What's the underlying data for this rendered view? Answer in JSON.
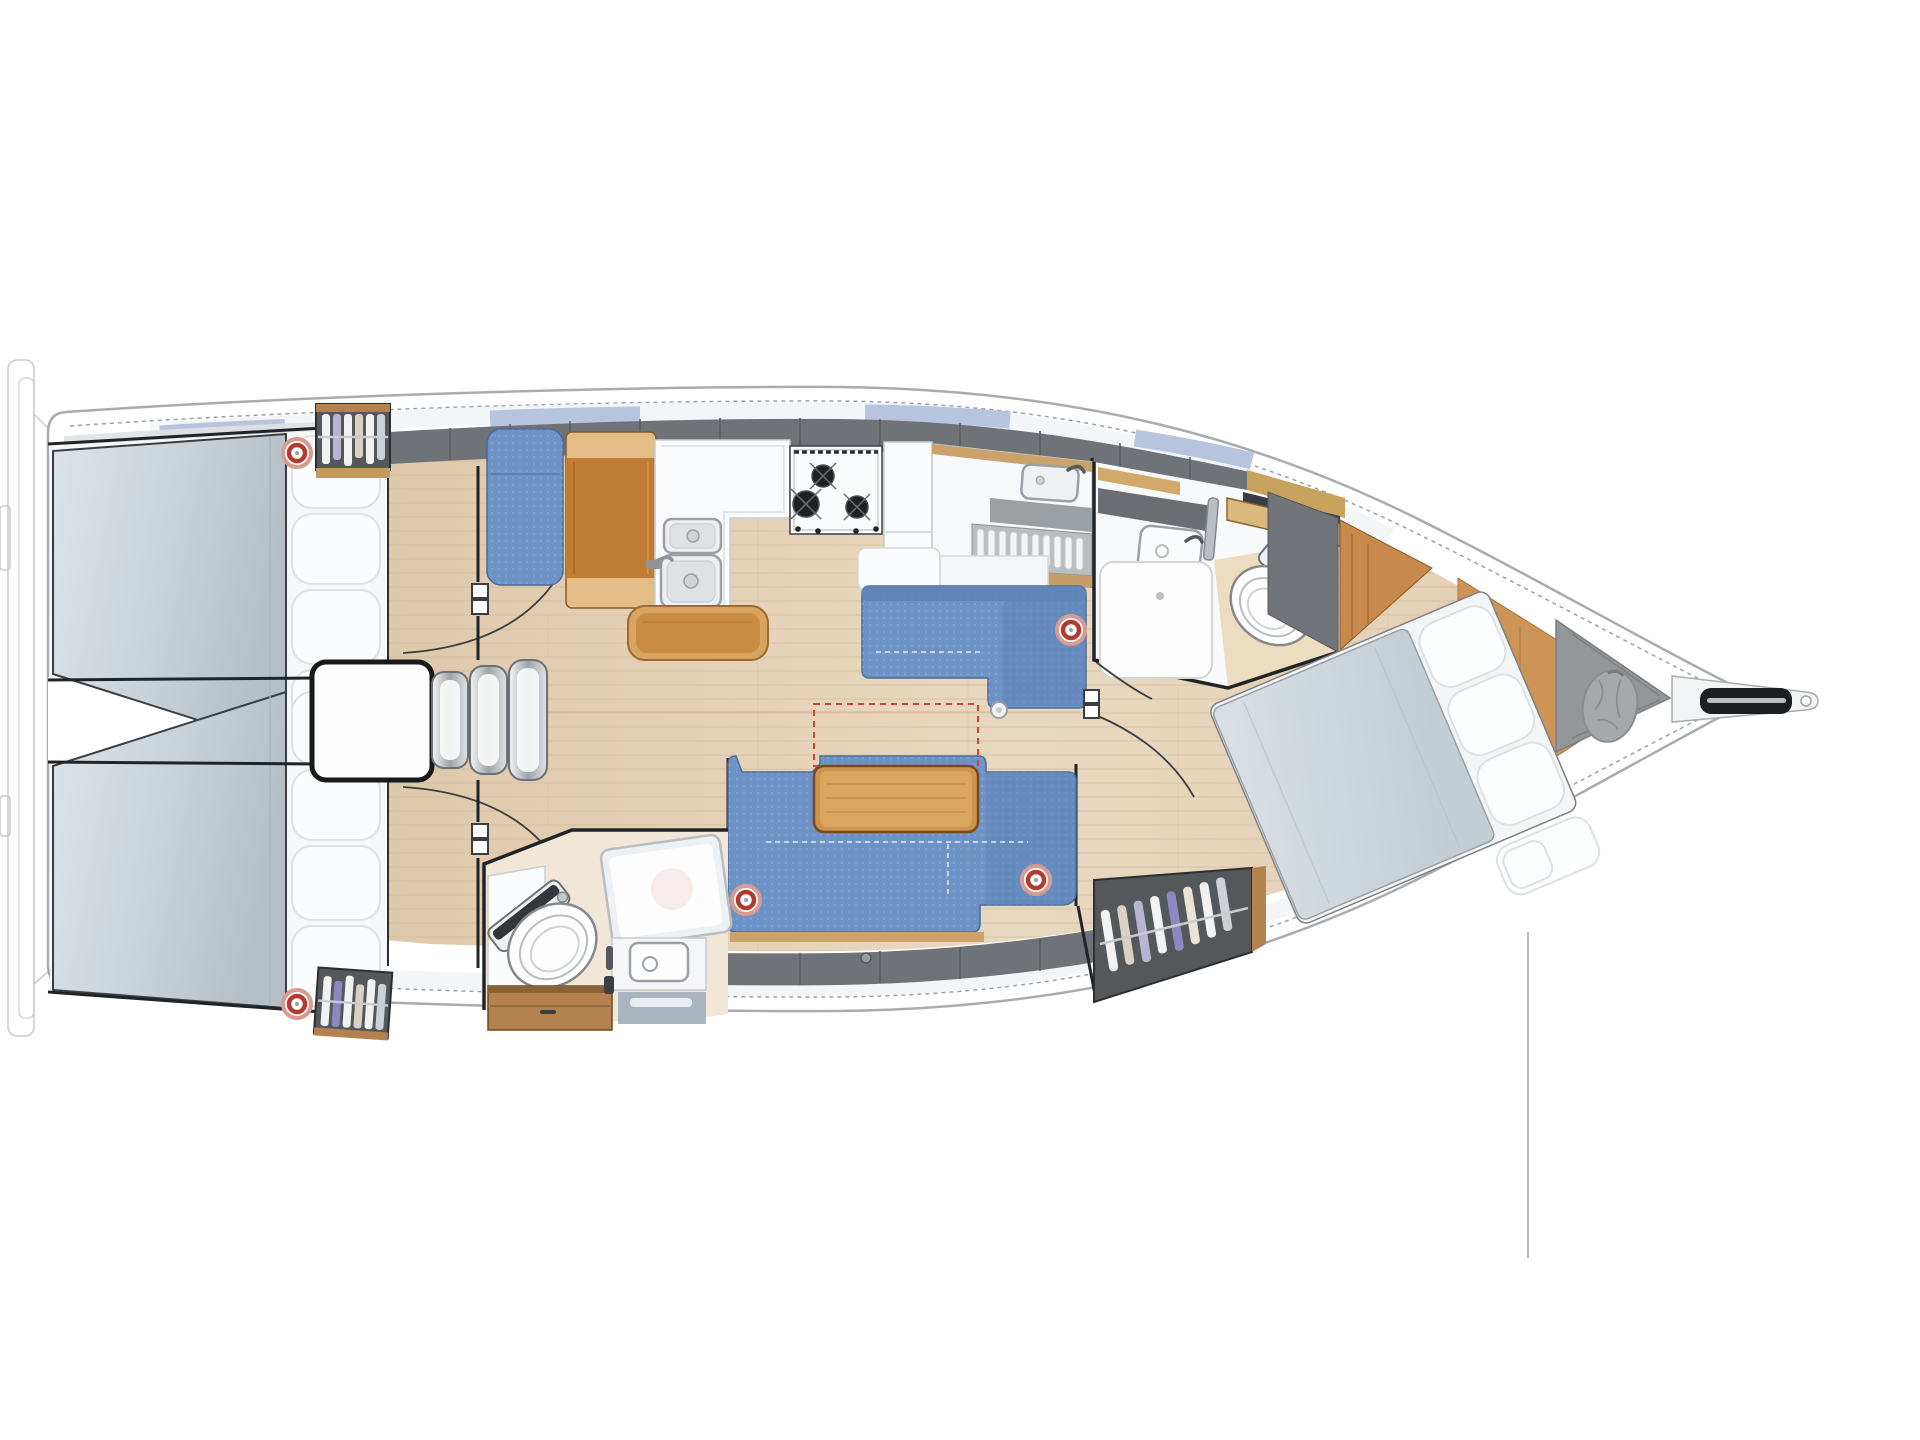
{
  "page": {
    "background": "#ffffff",
    "description": "Top-view interior floor plan of a sailing yacht, bow pointing right"
  },
  "colors": {
    "hull_fill": "#ffffff",
    "hull_outline": "#a8acb0",
    "toe_rail_dot": "#9aa0a4",
    "window_band": "#f3f6f9",
    "window_blue": "#b6c4dd",
    "side_light_gray": "#dfe1e3",
    "deck_gray": "#6f7276",
    "deck_gray_line": "#595c60",
    "floor_wood_light": "#ecdcc6",
    "floor_wood": "#e0cbaf",
    "floor_plank": "#d2b795",
    "wall_black": "#202427",
    "thin_line": "#c7cacd",
    "mattress_light": "#d6dee3",
    "mattress_dark": "#b9c4cc",
    "pillow_white": "#fbfcfd",
    "pillow_shade": "#dfe3e6",
    "sofa_blue": "#6e93c6",
    "sofa_blue_dark": "#5d82b6",
    "sofa_trim": "#c9a36b",
    "table_wood": "#cd9450",
    "table_wood_light": "#d9a55f",
    "table_edge": "#7a4a1e",
    "bench_wood": "#c88d42",
    "bench_wood_light": "#d8a45f",
    "chart_table_wood": "#c07c35",
    "chart_table_cap": "#e3bd85",
    "wardrobe_interior": "#55585b",
    "wardrobe_wood": "#b3824e",
    "clothes_white": "#f2f2f3",
    "clothes_purple": "#b9b3d6",
    "clothes_deep_purple": "#8f87c0",
    "clothes_tan": "#d9d2c4",
    "counter_white": "#fafbfc",
    "counter_line": "#c9cdd1",
    "sink_chrome": "#9aa0a5",
    "sink_basin": "#e9ebed",
    "stove_dark": "#1e2124",
    "gray_counter": "#9ba0a4",
    "plate_rack_bg": "#b9bdc0",
    "toilet_white": "#fdfdfe",
    "toilet_dark": "#33373b",
    "toilet_rim": "#85898d",
    "shower_glass": "#eef1f3",
    "shower_lower": "#aab3c0",
    "speaker_red": "#b23a30",
    "speaker_pink": "#d99a90",
    "dashed_red": "#c94436",
    "locker_gray": "#94979a",
    "bag_gray": "#a6a9ac",
    "bag_fold": "#8b8e91",
    "anchor_black": "#1c1f22",
    "anchor_silver": "#b9bec3",
    "step_chrome_light": "#f2f3f4",
    "step_chrome_dark": "#9ea3a7",
    "wood_panel": "#c8894c",
    "wood_shelf": "#d2a96a",
    "vanity_wood": "#d9b97e",
    "arc_stroke": "#3b3e40",
    "partition_gray": "#71757a"
  },
  "plan": {
    "type": "sailboat-interior-floor-plan",
    "orientation": "bow-right",
    "speaker_count": 5,
    "rooms": [
      {
        "id": "aft-cabin-port",
        "label": "aft double cabin (port)"
      },
      {
        "id": "aft-cabin-starboard",
        "label": "aft double cabin (starboard)"
      },
      {
        "id": "companionway",
        "label": "companionway steps over engine box"
      },
      {
        "id": "nav-station",
        "label": "chart table with seat"
      },
      {
        "id": "galley",
        "label": "L-galley: double sink, 3-burner stove, stowage"
      },
      {
        "id": "salon",
        "label": "salon with two settees and table"
      },
      {
        "id": "aft-head",
        "label": "aft head: toilet, vanity, shower"
      },
      {
        "id": "fwd-head",
        "label": "forward head: shower, sink, toilet"
      },
      {
        "id": "fwd-cabin",
        "label": "forward cabin with angled island berth"
      },
      {
        "id": "bow-locker",
        "label": "bow locker with sail bag and anchor roller"
      }
    ]
  }
}
